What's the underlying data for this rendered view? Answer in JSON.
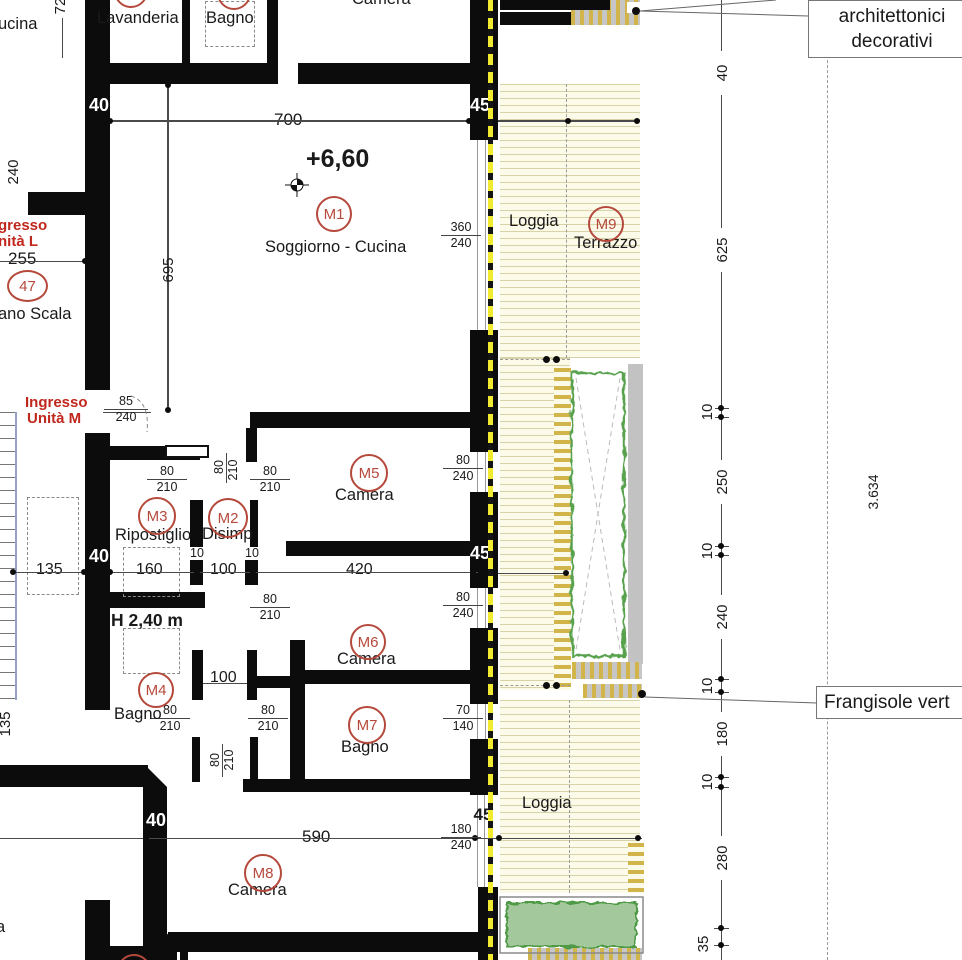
{
  "title": "Floor plan detail - Unit M, level +6,60",
  "colors": {
    "wall": "#0c0c0c",
    "tag_red": "#b5493b",
    "entrance_red": "#c0271d",
    "deck_cream": "#fcfae9",
    "deck_line": "#d8d2a9",
    "comb_yellow": "#d2b54a",
    "hedge_green": "#58a14e",
    "planter_green": "#a2c89c",
    "dashed_yellow": "#f0ea30",
    "gray_band": "#c2c2c2"
  },
  "t": {
    "cucina": "ucina",
    "lavanderia": "Lavanderia",
    "bagno_top": "Bagno",
    "camera_top": "Camera",
    "quota": "+6,60",
    "soggiorno": "Soggiorno - Cucina",
    "ing_l1": "gresso",
    "ing_l2": "nità L",
    "d255": "255",
    "n47": "47",
    "piano_scala": "ano Scala",
    "ing_m1": "Ingresso",
    "ing_m2": "Unità M",
    "d85": "85",
    "d240_ing": "240",
    "d700": "700",
    "d695": "695",
    "d72": "72",
    "d240_edge": "240",
    "d135_edge": "135",
    "partial_a": "a",
    "m1": "M1",
    "m2": "M2",
    "m3": "M3",
    "m4": "M4",
    "m5": "M5",
    "m6": "M6",
    "m7": "M7",
    "m8": "M8",
    "m9": "M9",
    "ripostiglio": "Ripostiglio",
    "disimp": "Disimp",
    "camera_m5": "Camera",
    "camera_m6": "Camera",
    "bagno_m4": "Bagno",
    "bagno_m7": "Bagno",
    "camera_m8": "Camera",
    "loggia_1": "Loggia",
    "terrazzo": "Terrazzo",
    "loggia_2": "Loggia",
    "d135_loggia": "135",
    "d134_loggia": "134",
    "d134_mid": "134",
    "d269": "269",
    "d160": "160",
    "d100_row": "100",
    "d420": "420",
    "d135_row": "135",
    "d10_a": "10",
    "d10_b": "10",
    "h240": "H 2,40 m",
    "d100_m4": "100",
    "d590": "590",
    "p80_1": "80",
    "p210_1": "210",
    "p80_2": "80",
    "p210_2": "210",
    "p80_3": "80",
    "p210_3": "210",
    "p80_4": "80",
    "p210_4": "210",
    "p80_5": "80",
    "p210_5": "210",
    "p80_6": "80",
    "p210_6": "210",
    "p80_7": "80",
    "p210_7": "210",
    "w360": "360",
    "w360b": "240",
    "w80a": "80",
    "w80ab": "240",
    "w80b": "80",
    "w80bb": "240",
    "w70": "70",
    "w70b": "140",
    "w180": "180",
    "w180b": "240",
    "wl40_a": "40",
    "wl40_b": "40",
    "wl40_c": "40",
    "wl45_a": "45",
    "wl45_b": "45",
    "wl45_c": "45",
    "c40": "40",
    "c625": "625",
    "c10_1": "10",
    "c250": "250",
    "c10_2": "10",
    "c240": "240",
    "c10_3": "10",
    "c180": "180",
    "c10_4": "10",
    "c280": "280",
    "c35": "35",
    "d3634": "3.634",
    "box1a": "architettonici",
    "box1b": "decorativi",
    "box2": "Frangisole vert"
  }
}
